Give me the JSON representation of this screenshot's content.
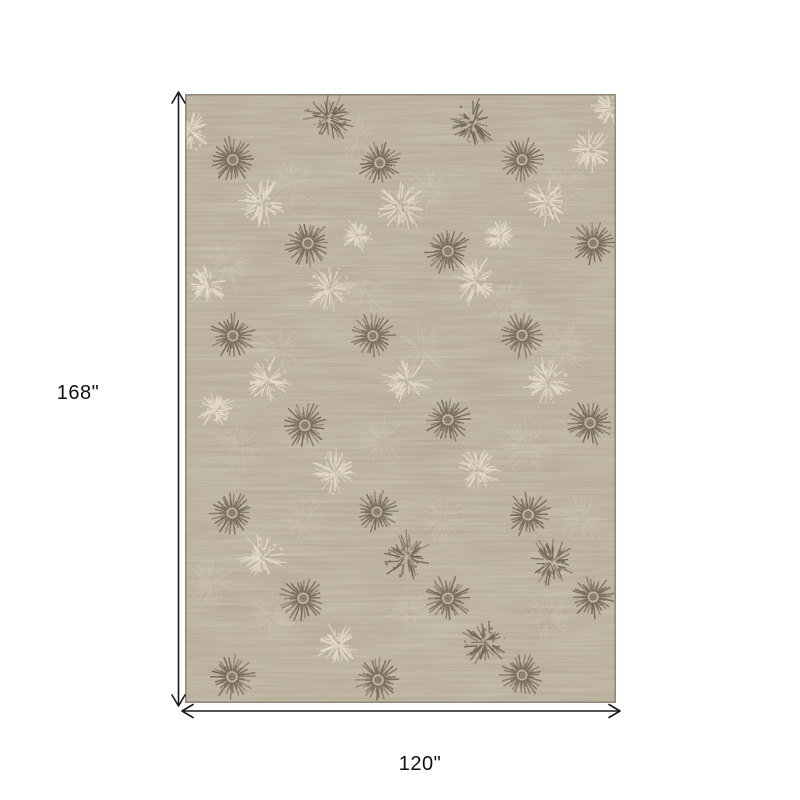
{
  "page": {
    "background_color": "#ffffff"
  },
  "diagram": {
    "height_label": "168\"",
    "width_label": "120\"",
    "arrow_color": "#1a1a1a",
    "label_color": "#111111"
  },
  "rug": {
    "alt": "taupe-beige-area-rug-with-sunburst-medallion-pattern",
    "base_color": "#b5a894",
    "border_color": "#7d715f",
    "motif_dark_color": "#675b48",
    "motif_light_color": "#e9e0cc",
    "motifs": [
      {
        "type": "sunburst",
        "tone": "dark",
        "x": 11.1,
        "y": 10.8,
        "size": 47
      },
      {
        "type": "sunburst",
        "tone": "dark",
        "x": 45.2,
        "y": 11.3,
        "size": 45
      },
      {
        "type": "sunburst",
        "tone": "dark",
        "x": 78.2,
        "y": 10.8,
        "size": 45
      },
      {
        "type": "sunburst",
        "tone": "dark",
        "x": 28.5,
        "y": 24.5,
        "size": 47
      },
      {
        "type": "sunburst",
        "tone": "dark",
        "x": 61.0,
        "y": 25.8,
        "size": 47
      },
      {
        "type": "sunburst",
        "tone": "dark",
        "x": 94.7,
        "y": 24.5,
        "size": 45
      },
      {
        "type": "sunburst",
        "tone": "dark",
        "x": 11.1,
        "y": 39.7,
        "size": 46
      },
      {
        "type": "sunburst",
        "tone": "dark",
        "x": 43.6,
        "y": 39.7,
        "size": 45
      },
      {
        "type": "sunburst",
        "tone": "dark",
        "x": 78.2,
        "y": 39.6,
        "size": 46
      },
      {
        "type": "sunburst",
        "tone": "dark",
        "x": 27.8,
        "y": 54.4,
        "size": 47
      },
      {
        "type": "sunburst",
        "tone": "dark",
        "x": 61.0,
        "y": 53.5,
        "size": 46
      },
      {
        "type": "sunburst",
        "tone": "dark",
        "x": 94.0,
        "y": 54.0,
        "size": 46
      },
      {
        "type": "sunburst",
        "tone": "dark",
        "x": 10.9,
        "y": 68.8,
        "size": 45
      },
      {
        "type": "sunburst",
        "tone": "dark",
        "x": 44.5,
        "y": 68.6,
        "size": 44
      },
      {
        "type": "sunburst",
        "tone": "dark",
        "x": 79.6,
        "y": 69.1,
        "size": 46
      },
      {
        "type": "sunburst",
        "tone": "dark",
        "x": 27.4,
        "y": 82.8,
        "size": 47
      },
      {
        "type": "sunburst",
        "tone": "dark",
        "x": 61.0,
        "y": 82.8,
        "size": 47
      },
      {
        "type": "sunburst",
        "tone": "dark",
        "x": 94.7,
        "y": 82.6,
        "size": 45
      },
      {
        "type": "sunburst",
        "tone": "dark",
        "x": 10.9,
        "y": 95.7,
        "size": 46
      },
      {
        "type": "sunburst",
        "tone": "dark",
        "x": 44.8,
        "y": 96.2,
        "size": 46
      },
      {
        "type": "sunburst",
        "tone": "dark",
        "x": 78.2,
        "y": 95.4,
        "size": 44
      },
      {
        "type": "tuft",
        "tone": "dark",
        "x": 33.2,
        "y": 3.9,
        "size": 52
      },
      {
        "type": "tuft",
        "tone": "dark",
        "x": 66.6,
        "y": 4.8,
        "size": 50
      },
      {
        "type": "tuft",
        "tone": "dark",
        "x": 51.5,
        "y": 76.0,
        "size": 52
      },
      {
        "type": "tuft",
        "tone": "dark",
        "x": 85.2,
        "y": 76.8,
        "size": 50
      },
      {
        "type": "tuft",
        "tone": "dark",
        "x": 69.6,
        "y": 90.0,
        "size": 50
      },
      {
        "type": "tuft",
        "tone": "light",
        "x": 1.2,
        "y": 6.1,
        "size": 46
      },
      {
        "type": "tuft",
        "tone": "light",
        "x": 99.1,
        "y": 2.3,
        "size": 44
      },
      {
        "type": "tuft",
        "tone": "light",
        "x": 94.0,
        "y": 9.2,
        "size": 46
      },
      {
        "type": "tuft",
        "tone": "light",
        "x": 17.9,
        "y": 17.9,
        "size": 52
      },
      {
        "type": "tuft",
        "tone": "light",
        "x": 49.9,
        "y": 18.4,
        "size": 54
      },
      {
        "type": "tuft",
        "tone": "light",
        "x": 84.0,
        "y": 17.6,
        "size": 50
      },
      {
        "type": "tuft",
        "tone": "light",
        "x": 39.9,
        "y": 23.2,
        "size": 34
      },
      {
        "type": "tuft",
        "tone": "light",
        "x": 73.1,
        "y": 23.3,
        "size": 34
      },
      {
        "type": "tuft",
        "tone": "light",
        "x": 33.6,
        "y": 31.9,
        "size": 52
      },
      {
        "type": "tuft",
        "tone": "light",
        "x": 67.7,
        "y": 30.7,
        "size": 50
      },
      {
        "type": "tuft",
        "tone": "light",
        "x": 5.3,
        "y": 31.4,
        "size": 40
      },
      {
        "type": "tuft",
        "tone": "light",
        "x": 19.0,
        "y": 47.0,
        "size": 50
      },
      {
        "type": "tuft",
        "tone": "light",
        "x": 51.5,
        "y": 47.0,
        "size": 52
      },
      {
        "type": "tuft",
        "tone": "light",
        "x": 84.2,
        "y": 47.3,
        "size": 50
      },
      {
        "type": "tuft",
        "tone": "light",
        "x": 7.0,
        "y": 51.9,
        "size": 40
      },
      {
        "type": "tuft",
        "tone": "light",
        "x": 34.8,
        "y": 62.2,
        "size": 50
      },
      {
        "type": "tuft",
        "tone": "light",
        "x": 68.0,
        "y": 61.7,
        "size": 48
      },
      {
        "type": "tuft",
        "tone": "light",
        "x": 17.9,
        "y": 76.0,
        "size": 50
      },
      {
        "type": "tuft",
        "tone": "light",
        "x": 35.5,
        "y": 90.5,
        "size": 50
      },
      {
        "type": "faint-tuft",
        "tone": "light",
        "x": 25,
        "y": 15,
        "size": 60
      },
      {
        "type": "faint-tuft",
        "tone": "light",
        "x": 57,
        "y": 16,
        "size": 56
      },
      {
        "type": "faint-tuft",
        "tone": "light",
        "x": 88,
        "y": 15,
        "size": 58
      },
      {
        "type": "faint-tuft",
        "tone": "light",
        "x": 10,
        "y": 28,
        "size": 54
      },
      {
        "type": "faint-tuft",
        "tone": "light",
        "x": 42,
        "y": 33,
        "size": 58
      },
      {
        "type": "faint-tuft",
        "tone": "light",
        "x": 75,
        "y": 34,
        "size": 56
      },
      {
        "type": "faint-tuft",
        "tone": "light",
        "x": 22,
        "y": 42,
        "size": 56
      },
      {
        "type": "faint-tuft",
        "tone": "light",
        "x": 55,
        "y": 42,
        "size": 54
      },
      {
        "type": "faint-tuft",
        "tone": "light",
        "x": 88,
        "y": 42,
        "size": 58
      },
      {
        "type": "faint-tuft",
        "tone": "light",
        "x": 13,
        "y": 58,
        "size": 56
      },
      {
        "type": "faint-tuft",
        "tone": "light",
        "x": 46,
        "y": 57,
        "size": 54
      },
      {
        "type": "faint-tuft",
        "tone": "light",
        "x": 79,
        "y": 58,
        "size": 58
      },
      {
        "type": "faint-tuft",
        "tone": "light",
        "x": 28,
        "y": 70,
        "size": 56
      },
      {
        "type": "faint-tuft",
        "tone": "light",
        "x": 60,
        "y": 70,
        "size": 54
      },
      {
        "type": "faint-tuft",
        "tone": "light",
        "x": 92,
        "y": 70,
        "size": 56
      },
      {
        "type": "faint-tuft",
        "tone": "light",
        "x": 20,
        "y": 86,
        "size": 54
      },
      {
        "type": "faint-tuft",
        "tone": "light",
        "x": 52,
        "y": 85,
        "size": 56
      },
      {
        "type": "faint-tuft",
        "tone": "light",
        "x": 84,
        "y": 86,
        "size": 54
      },
      {
        "type": "faint-tuft",
        "tone": "light",
        "x": 40,
        "y": 7,
        "size": 50
      },
      {
        "type": "faint-tuft",
        "tone": "light",
        "x": 6,
        "y": 80,
        "size": 50
      }
    ]
  }
}
